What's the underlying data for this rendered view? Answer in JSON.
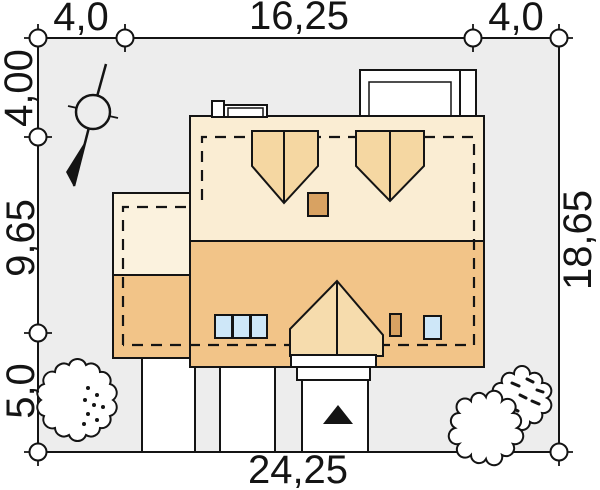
{
  "title": "Site plan - roof view with plot dimensions",
  "dims": {
    "top_left": "4,0",
    "top_mid": "16,25",
    "top_right": "4,0",
    "left_top": "4,00",
    "left_mid": "9,65",
    "left_bottom": "5,0",
    "right_side": "18,65",
    "bottom": "24,25"
  },
  "colors": {
    "plot_bg": "#EDEDED",
    "roof_upper": "#FAEDD3",
    "annex_upper": "#FBF2DE",
    "roof_lower": "#F2C488",
    "dormer": "#F5D7A2",
    "gable": "#F6DCAD",
    "chimney": "#D8A262",
    "skylight": "#CEE7F8",
    "line": "#141414"
  },
  "icons": {
    "north_arrow": "north-arrow-compass",
    "entrance_arrow": "entrance-direction-arrow",
    "tree_left": "tree-shrub",
    "tree_right": "tree-shrub-pair"
  }
}
